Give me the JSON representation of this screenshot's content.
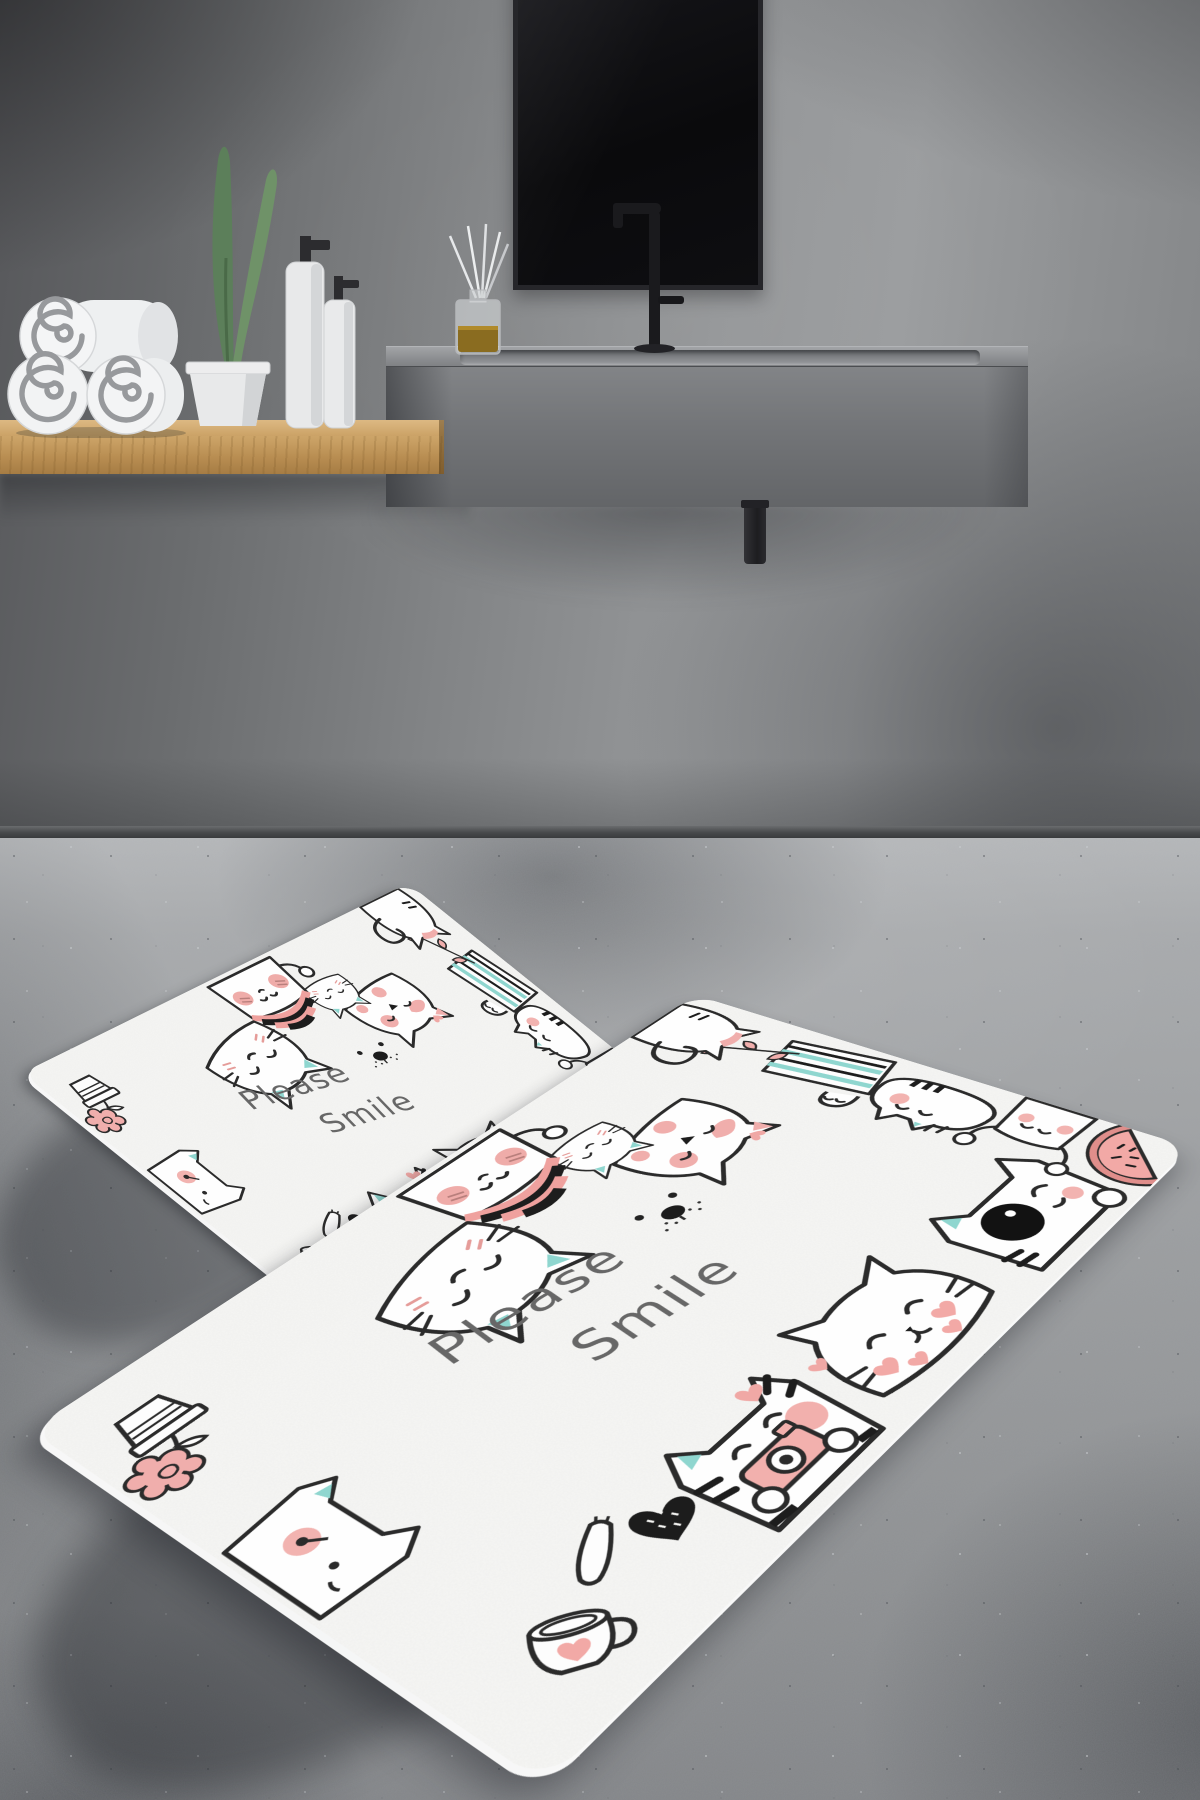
{
  "scene": {
    "type": "bathroom-product-photo",
    "subject": "2-piece bath mat set with cartoon cats on concrete floor"
  },
  "mat_set": {
    "text": {
      "line1": "Please",
      "line2": "Smile"
    },
    "pieces": [
      {
        "name": "large-bath-mat"
      },
      {
        "name": "small-bath-mat"
      }
    ],
    "doodles": [
      "cat-face-icon",
      "pillow-cat-icon",
      "beanie-cat-icon",
      "splotch-cat-icon",
      "eyepatch-cat-icon",
      "camera-cat-icon",
      "tail-cat-icon",
      "blanket-cat-icon",
      "tabby-cat-icon",
      "fist-cat-icon",
      "heart-cheek-cat-icon",
      "flower-pot-icon",
      "flower-string-icon",
      "watermelon-icon",
      "coffee-cup-icon",
      "black-heart-icon",
      "dog-face-icon",
      "paw-icon",
      "mini-heart-icon"
    ],
    "colors": {
      "mat_base": "#f6f6f4",
      "outline": "#2b2b2b",
      "pink": "#f0aeac",
      "teal": "#8fd6cf",
      "text_gray": "#676767",
      "black_accent": "#1c1c1c"
    }
  },
  "background": {
    "objects": [
      "wall",
      "baseboard",
      "mirror",
      "faucet",
      "vanity-sink",
      "drain-pipe",
      "wooden-shelf",
      "rolled-towels",
      "potted-plant",
      "soap-dispensers",
      "reed-diffuser",
      "concrete-floor"
    ],
    "colors": {
      "wall": "#8a8c8e",
      "floor": "#a3a5a7",
      "shelf_wood": "#c49c62",
      "mirror": "#0c0c0e",
      "vanity": "#747679"
    }
  }
}
